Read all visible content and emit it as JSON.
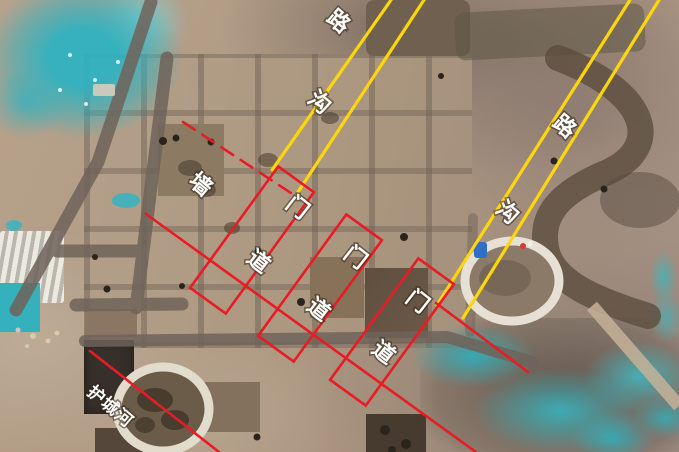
{
  "scene": {
    "type": "annotated aerial photograph",
    "subject": "Archaeological excavation site: grid of square trenches with overlaid survey annotations for roads, ditches, city wall, gateway passages and moat"
  },
  "colors": {
    "road_line_yellow": "#ffd60a",
    "annotation_red": "#e81c24",
    "label_text": "#ffffff",
    "tarp_teal": "#38b6c2",
    "soil_tan": "#b29a84"
  },
  "labels": {
    "left_road": "路",
    "left_ditch": "沟",
    "right_road": "路",
    "right_ditch": "沟",
    "wall": "墙",
    "gate1_door": "门",
    "gate1_path": "道",
    "gate2_door": "门",
    "gate2_path": "道",
    "gate3_door": "门",
    "gate3_path": "道",
    "moat": "护城河"
  }
}
